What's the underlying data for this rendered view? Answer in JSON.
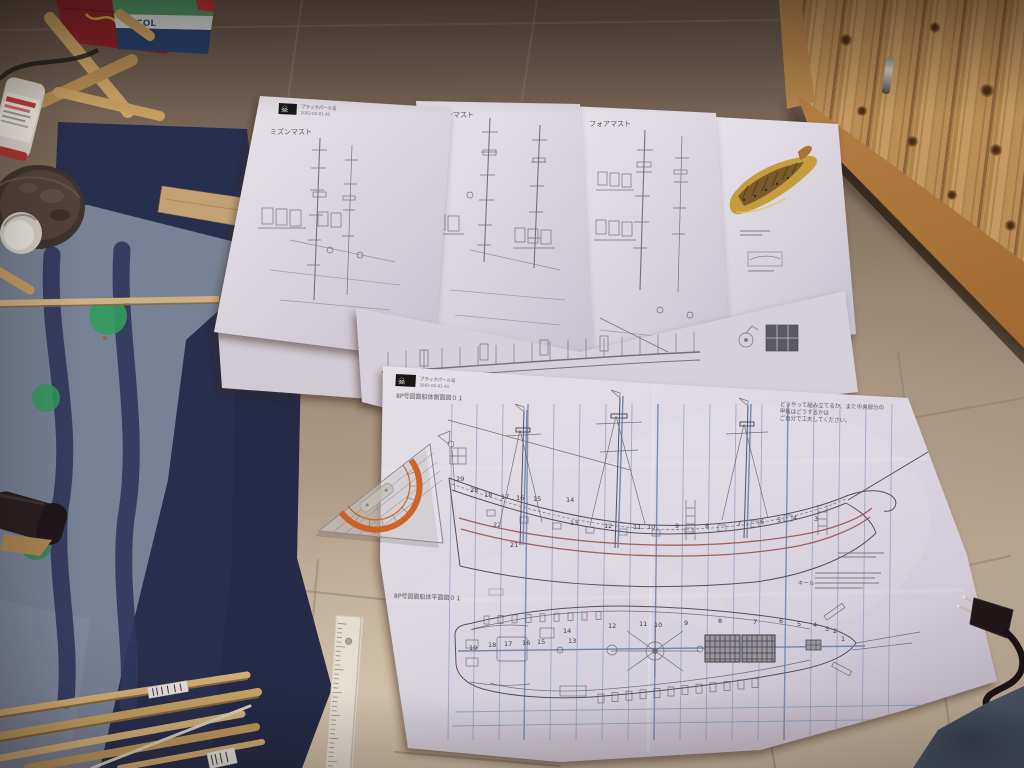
{
  "sheets": {
    "mizzen": {
      "title": "ミズンマスト"
    },
    "main": {
      "title": "メインマスト"
    },
    "fore": {
      "title": "フォアマスト"
    },
    "logo": {
      "glyph": "☠",
      "brand": "ブラックパール号",
      "issue": "2002-02-01 A1"
    },
    "hull": {
      "side_title": "8P号図面船体側面図０１",
      "plan_title": "8P号図面船体平面図０１",
      "note_lines": [
        "どうやって組み立てるか、また中央部分の",
        "甲板はどうするかは",
        "ご自分で工夫してください。"
      ],
      "keel_label": "キール",
      "side_frames_upper": [
        "29",
        "28",
        "18",
        "17",
        "16",
        "15",
        "14"
      ],
      "side_frames_lower": [
        "22",
        "13",
        "12",
        "11",
        "10",
        "9",
        "8",
        "7",
        "6",
        "5",
        "4",
        "3"
      ],
      "frame_21": "21",
      "plan_frames": [
        "19",
        "18",
        "17",
        "16",
        "15",
        "14",
        "13",
        "12",
        "11",
        "10",
        "9",
        "8",
        "7",
        "6",
        "5",
        "4",
        "3",
        "2",
        "1"
      ]
    }
  },
  "clutter": {
    "bag_text": "ECOL"
  },
  "colors": {
    "tile": "#b3a392",
    "tile_dark": "#6b5c50",
    "rug_light": "#76849b",
    "rug_navy": "#232c4d",
    "rug_dot_green": "#2e9e5e",
    "paper": "#e2dee9",
    "blueprint_ink": "#4c4c56",
    "blueprint_blue": "#8ba3c8",
    "blueprint_red": "#9b5151",
    "wood_cabinet": "#c0915a",
    "ruler_orange": "#d05a14",
    "dowel_tan": "#c9a565",
    "fabric_blue": "#5a7085"
  }
}
